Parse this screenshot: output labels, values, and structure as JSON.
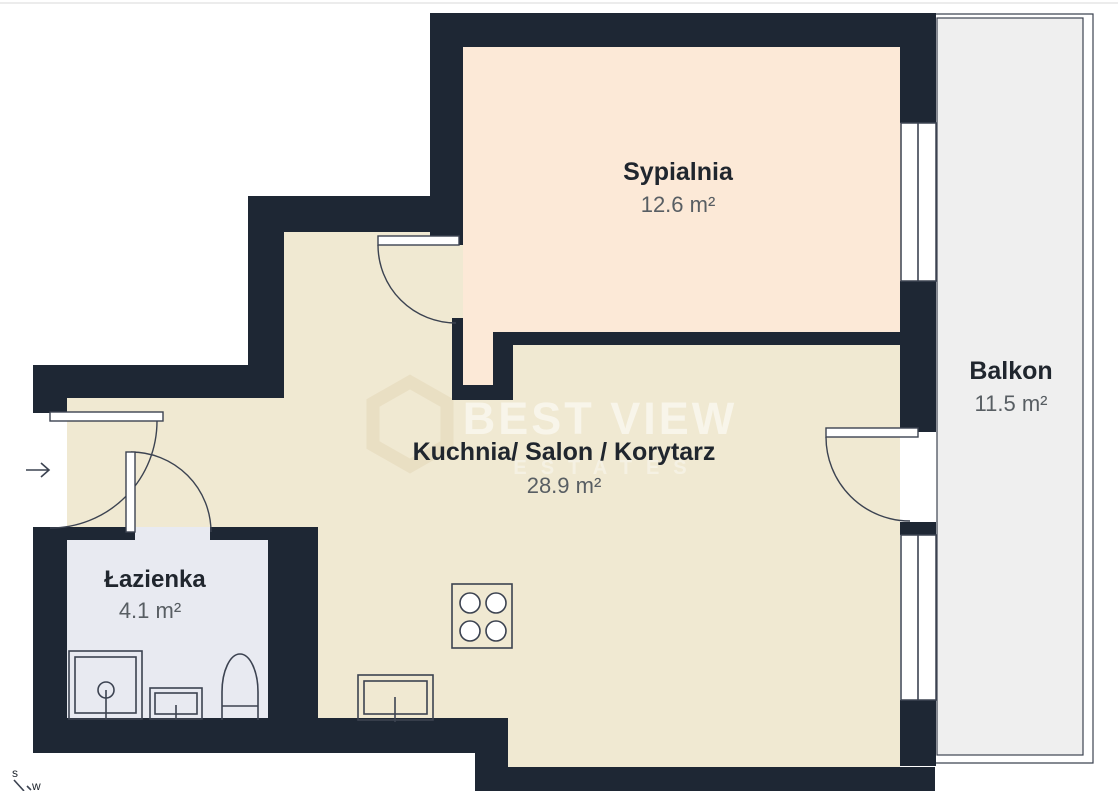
{
  "rooms": {
    "bedroom": {
      "name": "Sypialnia",
      "area": "12.6 m²"
    },
    "living": {
      "name": "Kuchnia/ Salon / Korytarz",
      "area": "28.9 m²"
    },
    "bathroom": {
      "name": "Łazienka",
      "area": "4.1 m²"
    },
    "balcony": {
      "name": "Balkon",
      "area": "11.5 m²"
    }
  },
  "watermark": {
    "brand_line1": "BEST VIEW",
    "brand_line2": "ESTATES",
    "logo": "house-outline-icon"
  },
  "compass": {
    "south_label": "s",
    "west_label": "w"
  },
  "fixtures": [
    "stove-icon",
    "kitchen-sink-icon",
    "shower-icon",
    "washbasin-icon",
    "toilet-icon"
  ],
  "doors": [
    "entry-door",
    "bathroom-door",
    "bedroom-door",
    "balcony-door"
  ],
  "windows": [
    "bedroom-window",
    "living-room-window"
  ],
  "colors": {
    "wall": "#1e2734",
    "bedroom_fill": "#fce9d7",
    "living_fill": "#f0e9d2",
    "bathroom_fill": "#e8eaf1",
    "balcony_fill": "#efefef",
    "line": "#3c4351",
    "label_text": "#20262e",
    "area_text": "#585e63",
    "watermark_text": "#ffffff",
    "watermark_logo": "#e7dcbf"
  }
}
